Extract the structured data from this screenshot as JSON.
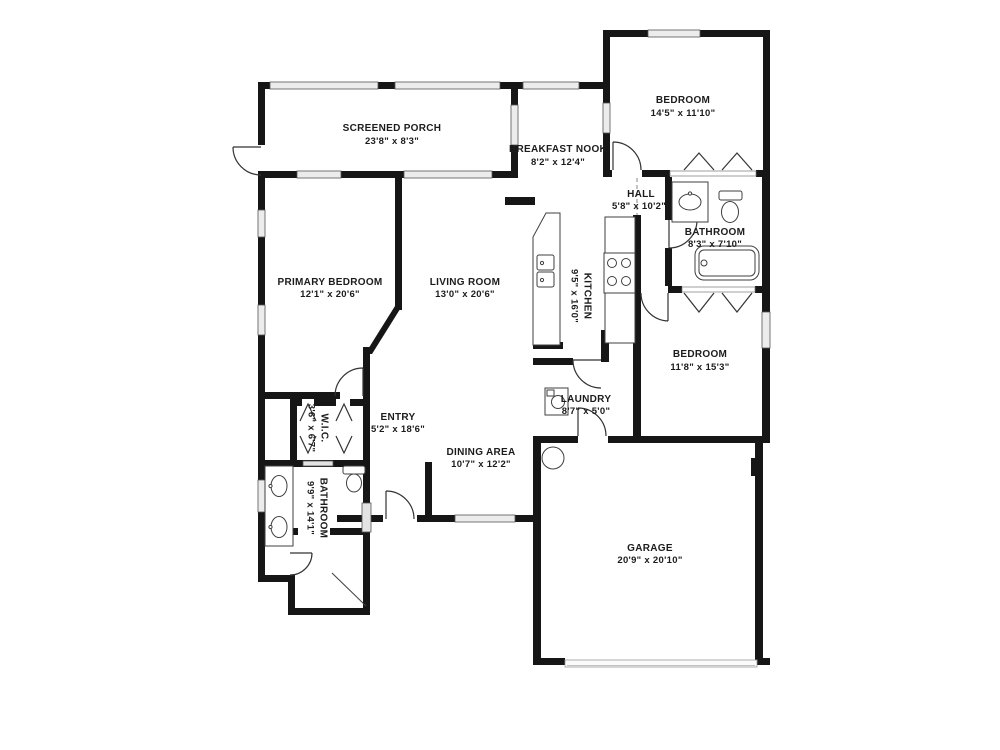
{
  "plan": {
    "type": "residential-floor-plan",
    "background_color": "#ffffff",
    "wall_color": "#161616",
    "window_color": "#ececec",
    "fixture_line_color": "#3f3f3f",
    "label_color": "#1c1c1c",
    "rooms": [
      {
        "name": "SCREENED PORCH",
        "dims": "23'8\" x 8'3\"",
        "orientation": "horizontal"
      },
      {
        "name": "BREAKFAST NOOK",
        "dims": "8'2\" x 12'4\"",
        "orientation": "horizontal"
      },
      {
        "name": "BEDROOM",
        "dims": "14'5\" x 11'10\"",
        "orientation": "horizontal"
      },
      {
        "name": "HALL",
        "dims": "5'8\" x 10'2\"",
        "orientation": "horizontal"
      },
      {
        "name": "BATHROOM",
        "dims": "8'3\" x 7'10\"",
        "orientation": "horizontal"
      },
      {
        "name": "PRIMARY BEDROOM",
        "dims": "12'1\" x 20'6\"",
        "orientation": "horizontal"
      },
      {
        "name": "LIVING ROOM",
        "dims": "13'0\" x 20'6\"",
        "orientation": "horizontal"
      },
      {
        "name": "KITCHEN",
        "dims": "9'5\" x 16'0\"",
        "orientation": "vertical"
      },
      {
        "name": "BEDROOM",
        "dims": "11'8\" x 15'3\"",
        "orientation": "horizontal"
      },
      {
        "name": "LAUNDRY",
        "dims": "8'7\" x 5'0\"",
        "orientation": "horizontal"
      },
      {
        "name": "W.I.C.",
        "dims": "3'6\" x 6'7\"",
        "orientation": "vertical"
      },
      {
        "name": "ENTRY",
        "dims": "5'2\" x 18'6\"",
        "orientation": "horizontal"
      },
      {
        "name": "DINING AREA",
        "dims": "10'7\" x 12'2\"",
        "orientation": "horizontal"
      },
      {
        "name": "BATHROOM",
        "dims": "9'9\" x 14'1\"",
        "orientation": "vertical"
      },
      {
        "name": "GARAGE",
        "dims": "20'9\" x 20'10\"",
        "orientation": "horizontal"
      }
    ],
    "fixtures": [
      "bathtub",
      "toilet-hall-bathroom",
      "sink-hall-bathroom",
      "double-vanity-sinks",
      "toilet-primary-bathroom",
      "shower",
      "kitchen-island-with-sink",
      "stove-cooktop",
      "kitchen-counter",
      "washer",
      "water-heater",
      "closet-bifold-doors",
      "door-swings",
      "windows",
      "sliding-glass-door",
      "garage-door"
    ]
  }
}
